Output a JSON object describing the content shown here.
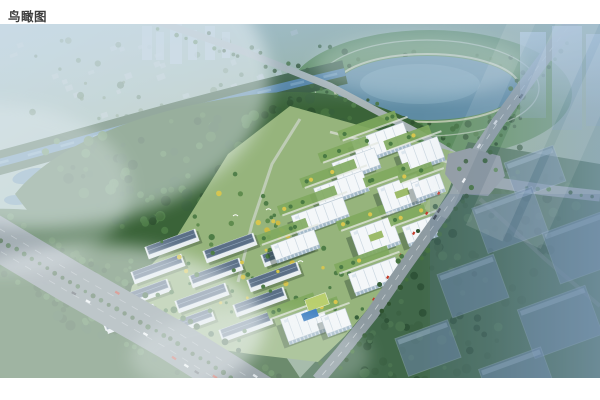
{
  "page": {
    "caption": "鸟瞰图",
    "background": "#ffffff"
  },
  "scene": {
    "type": "aerial-masterplan-rendering",
    "colors": {
      "terrain": "#8fab8d",
      "lake": "#5e8ba3",
      "lake_light": "#7fa9bd",
      "river": "#4e7fa3",
      "forest": "#3a6338",
      "forest_light": "#4b7a45",
      "forest_dark": "#2f5330",
      "park": "#5a8a58",
      "site_lawn": "#96b47c",
      "courtyard": "#7fa85e",
      "building_roof": "#f4f7f9",
      "building_face": "#b9cbd8",
      "townhouse_roof": "#5b6f86",
      "townhouse_wall": "#e9eef1",
      "road": "#8e9ba1",
      "road_minor": "#a7b2b4",
      "highway": "#7e8a90",
      "intersection": "#87929a",
      "ghost_building": "#6a85a4",
      "distant_block": "#b6c5cd",
      "tree_yellow": "#d8c64e",
      "accent_red": "#c23b2a",
      "path": "#e3e7df"
    }
  }
}
